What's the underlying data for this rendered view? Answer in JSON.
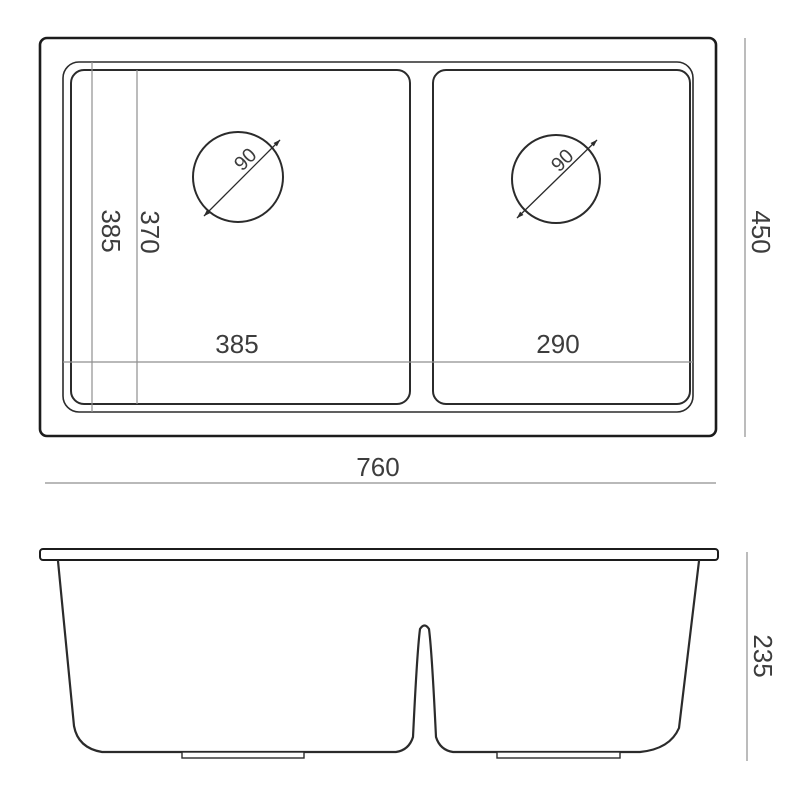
{
  "top_view": {
    "overall_width": "760",
    "overall_depth": "450",
    "left_bowl_width": "385",
    "right_bowl_width": "290",
    "rim_inner_depth": "385",
    "bowl_inner_depth": "370",
    "left_drain_diameter": "90",
    "right_drain_diameter": "90"
  },
  "front_view": {
    "bowl_depth": "235"
  },
  "colors": {
    "outline": "#1c1c1c",
    "line": "#2b2b2b",
    "dimension_line": "#8f8f8f",
    "text": "#3d3d3d",
    "background": "#ffffff"
  }
}
